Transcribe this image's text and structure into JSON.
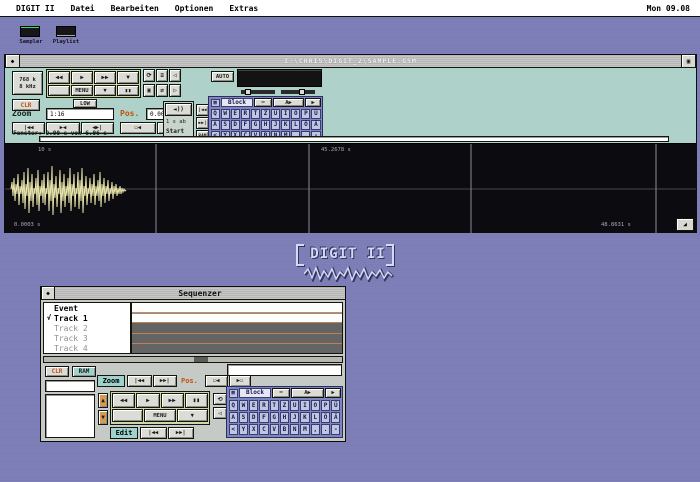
{
  "menu_bar": {
    "items": [
      "DIGIT II",
      "Datei",
      "Bearbeiten",
      "Optionen",
      "Extras"
    ],
    "clock": "Mon 09.08"
  },
  "desktop_icons": [
    {
      "label": "Sampler"
    },
    {
      "label": "Playlist"
    }
  ],
  "logo": {
    "title": "DIGIT II"
  },
  "sample_window": {
    "close_glyph": "◆",
    "fuller_glyph": "▣",
    "title": "I:\\CHRIS\\DIGIT_2\\SAMPLE.GSM",
    "info_line1": "768 k",
    "info_line2": "8 kHz",
    "clr": "CLR",
    "low": "LOW",
    "auto": "AUTO",
    "transport_row1": [
      "◀◀",
      "▶",
      "▶▶",
      "▼"
    ],
    "transport_row2": [
      "",
      "MENU",
      "▼",
      "▮▮"
    ],
    "icon_grid": [
      "⟳",
      "≡",
      "◁",
      "▣",
      "⇄",
      "▷"
    ],
    "zoom_label": "Zoom",
    "zoom_value": "1:16",
    "zoom_buttons": [
      "|◀◀",
      "▶◀",
      "◀▶|"
    ],
    "pos_label": "Pos.",
    "pos_value": "0.00s",
    "pos_buttons": [
      "▭◀",
      "▶▭"
    ],
    "start_icon": "◄))",
    "start_line": "1 s ab",
    "start_label": "Start",
    "stack_buttons": [
      "|◀◀",
      "▶▶|",
      "RAM"
    ],
    "status": "Fenster:  0.00 s  von   6.96 s",
    "wave_labels": {
      "top_left": "10 s",
      "top_mid": "45.2678 s",
      "bottom_left": "0.0003 s",
      "bottom_right": "48.8631 s"
    },
    "resize_glyph": "◢"
  },
  "keyboard": {
    "block_icon": "▦",
    "block_label": "Block",
    "tool_icon": "⌨",
    "tool_a": "A▶",
    "tool_b": "▶",
    "rows": [
      [
        "Q",
        "W",
        "E",
        "R",
        "T",
        "Z",
        "U",
        "I",
        "O",
        "P",
        "Ü"
      ],
      [
        "A",
        "S",
        "D",
        "F",
        "G",
        "H",
        "J",
        "K",
        "L",
        "Ö",
        "Ä"
      ],
      [
        "<",
        "Y",
        "X",
        "C",
        "V",
        "B",
        "N",
        "M",
        ",",
        ".",
        "-"
      ]
    ]
  },
  "sequencer": {
    "close_glyph": "◆",
    "title": "Sequenzer",
    "tracks": [
      {
        "check": "",
        "label": "Event"
      },
      {
        "check": "√",
        "label": "Track 1"
      },
      {
        "check": "",
        "label": "Track 2"
      },
      {
        "check": "",
        "label": "Track 3"
      },
      {
        "check": "",
        "label": "Track 4"
      }
    ],
    "clr": "CLR",
    "ram": "RAM",
    "zoom_label": "Zoom",
    "zoom_buttons": [
      "|◀◀",
      "▶▶|"
    ],
    "pos_label": "Pos.",
    "pos_buttons": [
      "▭◀",
      "▶▭"
    ],
    "up_button": "▲",
    "down_button": "▼",
    "transport_row1": [
      "◀◀",
      "▶",
      "▶▶",
      "▮▮"
    ],
    "transport_row2": [
      "",
      "MENU",
      "▼"
    ],
    "icon_grid": [
      "⟲",
      "▤",
      "◁",
      "▷"
    ],
    "edit_label": "Edit",
    "edit_buttons": [
      "|◀◀",
      "▶▶|"
    ]
  },
  "colors": {
    "desktop": "#7b7bb6",
    "panel_teal": "#aed2c9",
    "transport_green": "#ccd8a6",
    "keyboard_blue": "#7e86c0",
    "accent_orange": "#c2520e",
    "wave_yellow": "#e9e5ab",
    "track_dark": "#646464",
    "track_separator": "#c08254",
    "logo_blue": "#d2daf6"
  }
}
